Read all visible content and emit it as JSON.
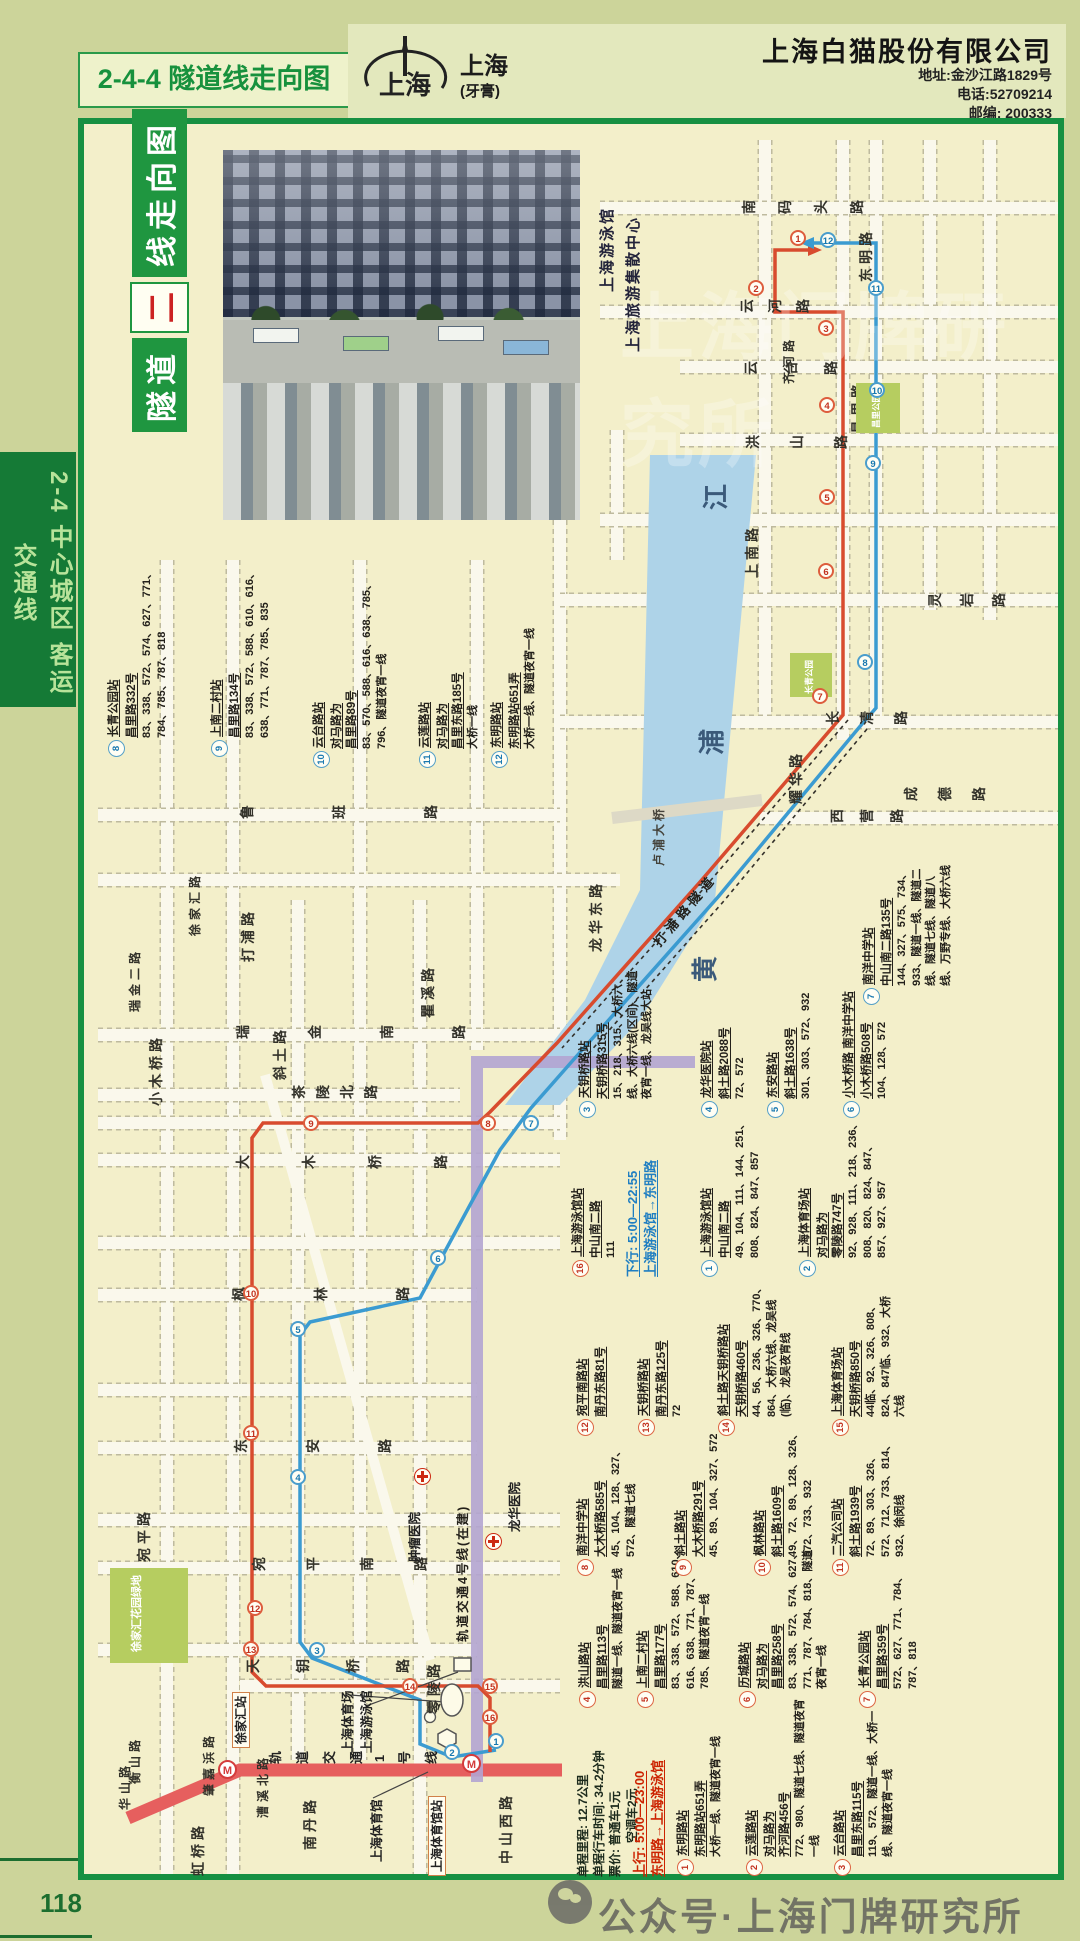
{
  "page": {
    "number": "118",
    "side_tab_line1": "2-4 中心城区",
    "side_tab_line2": "客运交通线",
    "footer_watermark": "公众号·上海门牌研究所",
    "map_watermark": "上海门牌研究所"
  },
  "header": {
    "section_code_title": "2-4-4 隧道线走向图",
    "brand": "上海",
    "brand_sub": "(牙膏)",
    "company": "上海白猫股份有限公司",
    "address": "地址:金沙江路1829号",
    "phone": "电话:52709214",
    "postcode": "邮编: 200333"
  },
  "map": {
    "title_part1": "隧道",
    "title_part2": "二",
    "title_part3": "线走向图",
    "photo_caption1": "上海游泳馆",
    "photo_caption2": "上海旅游集散中心",
    "river_chars": [
      {
        "t": "江",
        "x": 696,
        "y": 510
      },
      {
        "t": "浦",
        "x": 692,
        "y": 755
      },
      {
        "t": "黄",
        "x": 685,
        "y": 982
      }
    ],
    "tunnel_label": "打浦路隧道",
    "bridge_label": "卢浦大桥",
    "metro1_label": "轨道交通1号线",
    "metro4_label": "轨道交通4号线(在建)",
    "parks": [
      {
        "name": "徐家汇花园绿地",
        "x": 110,
        "y": 1568,
        "w": 78,
        "h": 95,
        "lx": 128,
        "ly": 1652,
        "fs": 11
      },
      {
        "name": "长青公园",
        "x": 790,
        "y": 653,
        "w": 42,
        "h": 44,
        "lx": 803,
        "ly": 694,
        "fs": 8.5
      },
      {
        "name": "昌里公园",
        "x": 856,
        "y": 383,
        "w": 44,
        "h": 50,
        "lx": 870,
        "ly": 428,
        "fs": 8.5
      }
    ],
    "hospitals": [
      {
        "name": "肿瘤医院",
        "cx": 422,
        "cy": 1476,
        "lx": 404,
        "ly": 1562
      },
      {
        "name": "龙华医院",
        "cx": 493,
        "cy": 1541,
        "lx": 504,
        "ly": 1532
      }
    ],
    "boxed_stations": [
      {
        "name": "徐家汇站",
        "x": 232,
        "y": 1748
      },
      {
        "name": "上海体育馆站",
        "x": 430,
        "y": 1876
      }
    ],
    "poi_labels": [
      {
        "name": "上海体育场",
        "x": 337,
        "y": 1753
      },
      {
        "name": "上海游泳馆",
        "x": 356,
        "y": 1753
      },
      {
        "name": "上海体育馆",
        "x": 366,
        "y": 1862
      }
    ],
    "streets": [
      {
        "t": "南码头路",
        "x": 742,
        "y": 215,
        "m": "h",
        "g": 22
      },
      {
        "t": "东明路",
        "x": 856,
        "y": 282,
        "m": "v"
      },
      {
        "t": "云河路",
        "x": 740,
        "y": 314,
        "m": "h",
        "g": 14
      },
      {
        "t": "齐河路",
        "x": 780,
        "y": 384,
        "m": "v",
        "fs": 12
      },
      {
        "t": "云台路",
        "x": 744,
        "y": 376,
        "m": "h",
        "g": 26
      },
      {
        "t": "洪山路",
        "x": 746,
        "y": 450,
        "m": "h",
        "g": 30
      },
      {
        "t": "昌里路",
        "x": 848,
        "y": 434,
        "m": "v"
      },
      {
        "t": "上南路",
        "x": 742,
        "y": 578,
        "m": "v"
      },
      {
        "t": "灵岩路",
        "x": 928,
        "y": 608,
        "m": "h",
        "g": 18
      },
      {
        "t": "长清路",
        "x": 826,
        "y": 726,
        "m": "h",
        "g": 20
      },
      {
        "t": "成德路",
        "x": 904,
        "y": 802,
        "m": "h",
        "g": 20
      },
      {
        "t": "西营路",
        "x": 830,
        "y": 824,
        "m": "h",
        "g": 16
      },
      {
        "t": "耀华路",
        "x": 786,
        "y": 804,
        "m": "v"
      },
      {
        "t": "龙华东路",
        "x": 586,
        "y": 952,
        "m": "v"
      },
      {
        "t": "鲁班路",
        "x": 240,
        "y": 820,
        "m": "h",
        "g": 78
      },
      {
        "t": "徐家汇路",
        "x": 186,
        "y": 936,
        "m": "v",
        "fs": 12
      },
      {
        "t": "打浦路",
        "x": 238,
        "y": 962,
        "m": "v"
      },
      {
        "t": "瑞金二路",
        "x": 126,
        "y": 1012,
        "m": "v",
        "fs": 12
      },
      {
        "t": "瑞金南路",
        "x": 236,
        "y": 1040,
        "m": "h",
        "g": 58
      },
      {
        "t": "斜土路",
        "x": 270,
        "y": 1080,
        "m": "v"
      },
      {
        "t": "瞿溪路",
        "x": 418,
        "y": 1018,
        "m": "v"
      },
      {
        "t": "茶陵北路",
        "x": 292,
        "y": 1100,
        "m": "h",
        "g": 10
      },
      {
        "t": "大木桥路",
        "x": 236,
        "y": 1170,
        "m": "h",
        "g": 52
      },
      {
        "t": "小木桥路",
        "x": 146,
        "y": 1106,
        "m": "v"
      },
      {
        "t": "枫林路",
        "x": 232,
        "y": 1302,
        "m": "h",
        "g": 68
      },
      {
        "t": "东安路",
        "x": 234,
        "y": 1454,
        "m": "h",
        "g": 58
      },
      {
        "t": "宛平路",
        "x": 134,
        "y": 1562,
        "m": "v"
      },
      {
        "t": "宛平南路",
        "x": 252,
        "y": 1572,
        "m": "h",
        "g": 40
      },
      {
        "t": "天钥桥路",
        "x": 246,
        "y": 1674,
        "m": "h",
        "g": 36
      },
      {
        "t": "零陵路",
        "x": 424,
        "y": 1714,
        "m": "v"
      },
      {
        "t": "肇嘉浜路",
        "x": 200,
        "y": 1796,
        "m": "v",
        "fs": 12
      },
      {
        "t": "南丹路",
        "x": 300,
        "y": 1850,
        "m": "v"
      },
      {
        "t": "虹桥路",
        "x": 188,
        "y": 1876,
        "m": "v"
      },
      {
        "t": "华山路",
        "x": 116,
        "y": 1810,
        "m": "v",
        "fs": 12
      },
      {
        "t": "衡山路",
        "x": 126,
        "y": 1784,
        "m": "v",
        "fs": 12
      },
      {
        "t": "漕溪北路",
        "x": 254,
        "y": 1818,
        "m": "v",
        "fs": 12
      },
      {
        "t": "中山西路",
        "x": 496,
        "y": 1864,
        "m": "v"
      }
    ]
  },
  "notes": {
    "mileage": "单程里程: 12.7公里",
    "time": "单程行车时间: 34.2分钟",
    "fare1": "票价: 普通车1元",
    "fare2": "空调车2元",
    "up_title": "上行: 5:00—23:00",
    "up_route": "东明路→上海游泳馆",
    "down_title": "下行: 5:00—22:55",
    "down_route": "上海游泳馆→东明路"
  },
  "up_line": {
    "name": "隧道二线 上行",
    "color": "#d84b2e",
    "stations": [
      {
        "n": 1,
        "name": "东明路站",
        "addr": "东明路站651弄",
        "routes": "大桥一线、隧道夜宵一线",
        "bx": 676,
        "by": 1876,
        "w": 180,
        "cx": 798,
        "cy": 238
      },
      {
        "n": 2,
        "name": "云莲路站",
        "name2": "对马路为",
        "addr": "齐河路456号",
        "routes": "772、980、隧道七线、隧道夜宵一线",
        "bx": 745,
        "by": 1876,
        "w": 180,
        "cx": 756,
        "cy": 288
      },
      {
        "n": 3,
        "name": "云台路站",
        "addr": "昌里东路115号",
        "routes": "119、572、隧道一线、大桥一线、隧道夜宵一线",
        "bx": 833,
        "by": 1876,
        "w": 180,
        "cx": 826,
        "cy": 328
      },
      {
        "n": 4,
        "name": "洪山路站",
        "addr": "昌里路113号",
        "routes": "隧道一线、隧道夜宵一线",
        "bx": 578,
        "by": 1708,
        "w": 160,
        "cx": 827,
        "cy": 405
      },
      {
        "n": 5,
        "name": "上南二村站",
        "addr": "昌里路177号",
        "routes": "83、338、572、588、610、616、638、771、787、785、隧道夜宵一线",
        "bx": 636,
        "by": 1708,
        "w": 160,
        "cx": 827,
        "cy": 497
      },
      {
        "n": 6,
        "name": "历城路站",
        "name2": "对马路为",
        "addr": "昌里路258号",
        "routes": "83、338、572、574、627、771、787、784、818、隧道夜宵一线",
        "bx": 738,
        "by": 1708,
        "w": 160,
        "cx": 826,
        "cy": 571
      },
      {
        "n": 7,
        "name": "长青公园站",
        "addr": "昌里路359号",
        "routes": "572、627、771、784、787、818",
        "bx": 858,
        "by": 1708,
        "w": 160,
        "cx": 820,
        "cy": 696
      },
      {
        "n": 8,
        "name": "南洋中学站",
        "addr": "大木桥路585号",
        "routes": "45、104、128、327、572、隧道七线",
        "bx": 576,
        "by": 1576,
        "w": 150,
        "cx": 488,
        "cy": 1123
      },
      {
        "n": 9,
        "name": "斜土路站",
        "addr": "大木桥路291号",
        "routes": "45、89、104、327、572",
        "bx": 674,
        "by": 1576,
        "w": 150,
        "cx": 311,
        "cy": 1123
      },
      {
        "n": 10,
        "name": "枫林路站",
        "addr": "斜土路1609号",
        "routes": "49、72、89、128、326、572、733、932",
        "bx": 753,
        "by": 1576,
        "w": 150,
        "cx": 251,
        "cy": 1293
      },
      {
        "n": 11,
        "name": "二汽公司站",
        "addr": "斜土路1939号",
        "routes": "72、89、303、326、572、712、733、814、932、徐闵线",
        "bx": 831,
        "by": 1576,
        "w": 150,
        "cx": 251,
        "cy": 1433
      },
      {
        "n": 12,
        "name": "宛平南路站",
        "addr": "南丹东路81号",
        "routes": "",
        "bx": 576,
        "by": 1436,
        "w": 130,
        "cx": 255,
        "cy": 1608
      },
      {
        "n": 13,
        "name": "天钥桥路站",
        "addr": "南丹东路125号",
        "routes": "72",
        "bx": 637,
        "by": 1436,
        "w": 130,
        "cx": 251,
        "cy": 1649
      },
      {
        "n": 14,
        "name": "斜土路天钥桥路站",
        "addr": "天钥桥路460号",
        "routes": "44、56、236、326、770、864、大桥六线、龙吴线(临)、龙吴夜宵线",
        "bx": 717,
        "by": 1436,
        "w": 165,
        "cx": 410,
        "cy": 1686
      },
      {
        "n": 15,
        "name": "上海体育场站",
        "addr": "天钥桥路850号",
        "routes": "44临、92、326、808、824、847临、932、大桥六线",
        "bx": 831,
        "by": 1436,
        "w": 150,
        "cx": 490,
        "cy": 1686
      },
      {
        "n": 16,
        "name": "上海游泳馆站",
        "addr": "中山南二路",
        "routes": "111",
        "bx": 571,
        "by": 1277,
        "w": 165,
        "cx": 490,
        "cy": 1717
      }
    ]
  },
  "down_line": {
    "name": "隧道二线 下行",
    "color": "#3b9bd1",
    "stations": [
      {
        "n": 1,
        "name": "上海游泳馆站",
        "addr": "中山南二路",
        "routes": "49、104、111、144、251、808、824、847、857",
        "bx": 700,
        "by": 1277,
        "w": 165,
        "cx": 496,
        "cy": 1741
      },
      {
        "n": 2,
        "name": "上海体育场站",
        "name2": "对马路为",
        "addr": "零陵路747号",
        "routes": "92、928、111、218、236、808、820、824、847、857、927、957",
        "bx": 798,
        "by": 1277,
        "w": 165,
        "cx": 452,
        "cy": 1752
      },
      {
        "n": 3,
        "name": "天钥桥路站",
        "addr": "天钥桥路315号",
        "routes": "15、218、315、大桥六线、大桥六线(区间)、隧道夜宵一线、龙吴线大站",
        "bx": 578,
        "by": 1118,
        "w": 150,
        "cx": 317,
        "cy": 1650
      },
      {
        "n": 4,
        "name": "龙华医院站",
        "addr": "斜土路2088号",
        "routes": "72、572",
        "bx": 700,
        "by": 1118,
        "w": 150,
        "cx": 298,
        "cy": 1477
      },
      {
        "n": 5,
        "name": "东安路站",
        "addr": "斜土路1638号",
        "routes": "301、303、572、932",
        "bx": 766,
        "by": 1118,
        "w": 150,
        "cx": 298,
        "cy": 1329
      },
      {
        "n": 6,
        "name": "小木桥路 南洋中学站",
        "addr": "小木桥路508号",
        "routes": "104、128、572",
        "bx": 842,
        "by": 1118,
        "w": 150,
        "cx": 438,
        "cy": 1258
      },
      {
        "n": 7,
        "name": "南洋中学站",
        "addr": "中山南二路135号",
        "routes": "144、327、575、734、933、隧道一线、隧道二线、隧道七线、隧道八线、万野专线、大桥六线",
        "bx": 862,
        "by": 1005,
        "w": 150,
        "cx": 531,
        "cy": 1123
      },
      {
        "n": 8,
        "name": "长青公园站",
        "addr": "昌里路332号",
        "routes": "83、338、572、574、627、771、784、785、787、818",
        "bx": 107,
        "by": 757,
        "w": 195,
        "cx": 865,
        "cy": 662
      },
      {
        "n": 9,
        "name": "上南二村站",
        "addr": "昌里路134号",
        "routes": "83、338、572、588、610、616、638、771、787、785、835",
        "bx": 210,
        "by": 757,
        "w": 195,
        "cx": 873,
        "cy": 463
      },
      {
        "n": 10,
        "name": "云台路站",
        "name2": "对马路为",
        "addr": "昌里路89号",
        "routes": "83、570、588、616、638、785、796、隧道夜宵一线",
        "bx": 312,
        "by": 768,
        "w": 200,
        "cx": 877,
        "cy": 390
      },
      {
        "n": 11,
        "name": "云莲路站",
        "name2": "对马路为",
        "addr": "昌里东路185号",
        "routes": "大桥一线",
        "bx": 418,
        "by": 768,
        "w": 200,
        "cx": 876,
        "cy": 288
      },
      {
        "n": 12,
        "name": "东明路站",
        "addr": "东明路站651弄",
        "routes": "大桥一线、隧道夜宵一线",
        "bx": 490,
        "by": 768,
        "w": 200,
        "cx": 828,
        "cy": 240
      }
    ]
  }
}
